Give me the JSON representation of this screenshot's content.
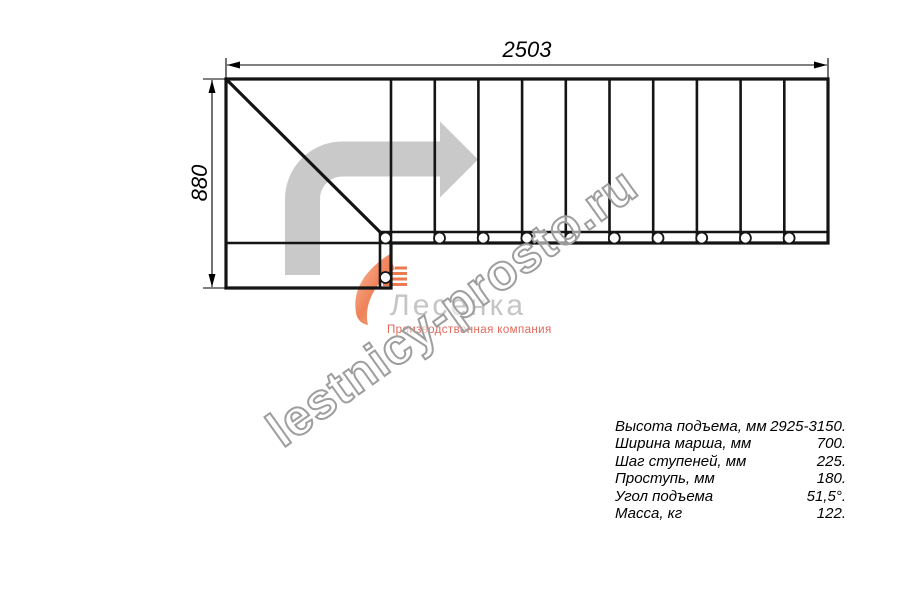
{
  "drawing": {
    "width_label": "2503",
    "height_label": "880"
  },
  "watermark": {
    "text": "lestnicy-prosto.ru"
  },
  "logo": {
    "name": "Лесенка",
    "tagline": "Производственная компания"
  },
  "specs": {
    "rows": [
      {
        "label": "Высота подъема, мм",
        "value": "2925-3150."
      },
      {
        "label": "Ширина марша, мм",
        "value": "700."
      },
      {
        "label": "Шаг ступеней, мм",
        "value": "225."
      },
      {
        "label": "Проступь, мм",
        "value": "180."
      },
      {
        "label": "Угол подъема",
        "value": "51,5°."
      },
      {
        "label": "Масса, кг",
        "value": "122."
      }
    ]
  },
  "colors": {
    "line": "#141414",
    "arrow": "#c9c9c9",
    "watermark": "#9e9e9e",
    "logo_text": "#c5c5c5",
    "logo_accent": "#e2685c",
    "logo_orange": "#ed7d55"
  }
}
